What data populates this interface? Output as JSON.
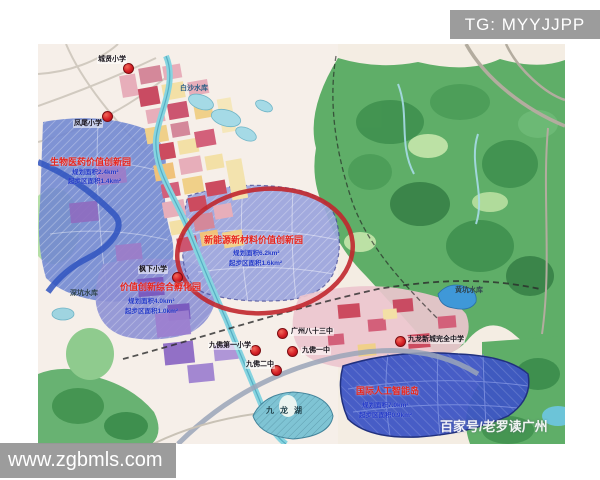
{
  "watermarks": {
    "tg": "TG: MYYJJPP",
    "website": "www.zgbmls.com",
    "credit": "百家号/老罗读广州"
  },
  "map": {
    "zones": [
      {
        "name": "生物医药价值创新园",
        "line1": "规划面积2.4km²",
        "line2": "起步区面积1.4km²"
      },
      {
        "name": "新能源新材料价值创新园",
        "line1": "规划面积6.2km²",
        "line2": "起步区面积1.6km²"
      },
      {
        "name": "价值创新综合孵化园",
        "line1": "规划面积4.0km²",
        "line2": "起步区面积1.0km²"
      },
      {
        "name": "国际人工智能岛",
        "line1": "规划面积7.0km²",
        "line2": "起步区面积0.9km²"
      }
    ],
    "schools": [
      "城贤小学",
      "凤尾小学",
      "枫下小学",
      "九佛第一小学",
      "广州八十三中",
      "九佛一中",
      "九佛二中",
      "九龙新城完全中学"
    ],
    "waters": [
      "白沙水库",
      "深坑水库",
      "黄坑水库",
      "九龙湖"
    ],
    "colors": {
      "highlight_circle": "#c1272d",
      "school_marker": "#d51f26",
      "watermark_bg": "#979797",
      "zone_blue": "#7288d2",
      "zone_purple": "#9aa4dc",
      "zone_dark_blue": "#3d55c4",
      "terrain_green": "#53a860"
    }
  }
}
